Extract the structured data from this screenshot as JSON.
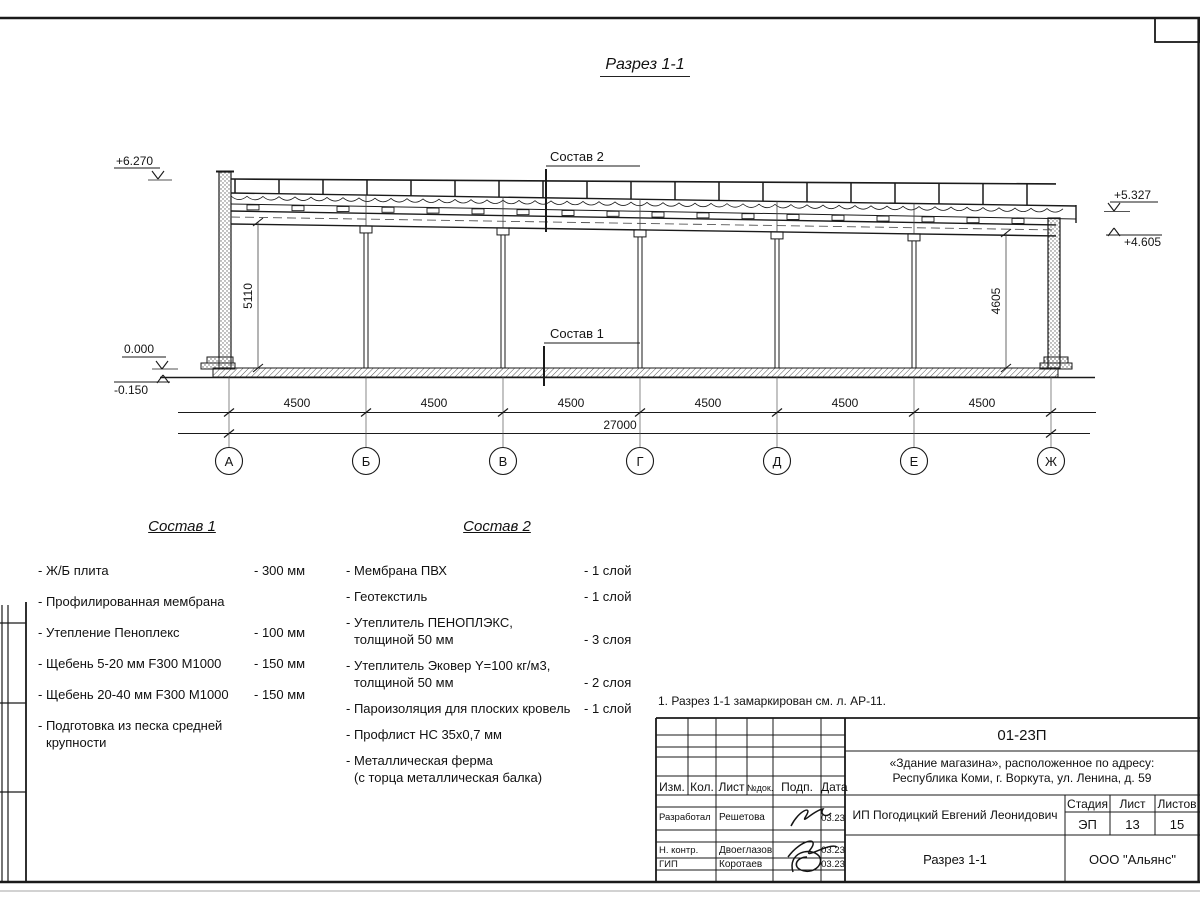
{
  "sheet": {
    "title": "Разрез 1-1",
    "note": "1. Разрез 1-1 замаркирован см. л. АР-11."
  },
  "drawing": {
    "elev_parapet": "+6.270",
    "elev_roof_high": "+5.327",
    "elev_roof_low": "+4.605",
    "elev_zero": "0.000",
    "elev_floor": "-0.150",
    "callout_roof": "Состав 2",
    "callout_floor": "Состав 1",
    "height_left": "5110",
    "height_right": "4605",
    "spans": [
      "4500",
      "4500",
      "4500",
      "4500",
      "4500",
      "4500"
    ],
    "total": "27000",
    "axes": [
      "А",
      "Б",
      "В",
      "Г",
      "Д",
      "Е",
      "Ж"
    ]
  },
  "sostav1": {
    "title": "Состав 1",
    "items": [
      {
        "name": "- Ж/Б плита",
        "name2": "",
        "value": "- 300 мм"
      },
      {
        "name": "- Профилированная мембрана",
        "name2": "",
        "value": ""
      },
      {
        "name": "- Утепление Пеноплекс",
        "name2": "",
        "value": "- 100 мм"
      },
      {
        "name": "-  Щебень 5-20 мм F300 М1000",
        "name2": "",
        "value": "- 150 мм"
      },
      {
        "name": "-  Щебень 20-40 мм F300 М1000",
        "name2": "",
        "value": "- 150 мм"
      },
      {
        "name": "- Подготовка из песка средней",
        "name2": "крупности",
        "value": ""
      }
    ]
  },
  "sostav2": {
    "title": "Состав 2",
    "items": [
      {
        "name": "- Мембрана ПВХ",
        "name2": "",
        "value": "- 1 слой"
      },
      {
        "name": "- Геотекстиль",
        "name2": "",
        "value": "- 1 слой"
      },
      {
        "name": "- Утеплитель ПЕНОПЛЭКС,",
        "name2": "толщиной 50 мм",
        "value": "- 3 слоя"
      },
      {
        "name": "- Утеплитель Эковер Y=100 кг/м3,",
        "name2": "толщиной 50 мм",
        "value": "- 2 слоя"
      },
      {
        "name": "- Пароизоляция для плоских кровель",
        "name2": "",
        "value": "- 1 слой"
      },
      {
        "name": "- Профлист НС 35х0,7 мм",
        "name2": "",
        "value": ""
      },
      {
        "name": "- Металлическая ферма",
        "name2": "(с торца металлическая балка)",
        "value": ""
      }
    ]
  },
  "titleblock": {
    "doc_number": "01-23П",
    "project_line1": "«Здание магазина», расположенное по адресу:",
    "project_line2": "Республика Коми, г. Воркута, ул. Ленина, д. 59",
    "client": "ИП Погодицкий Евгений Леонидович",
    "drawing_name": "Разрез 1-1",
    "company": "ООО \"Альянс\"",
    "stage_label": "Стадия",
    "sheet_label": "Лист",
    "sheets_label": "Листов",
    "stage": "ЭП",
    "sheet_no": "13",
    "sheets_total": "15",
    "header": [
      "Изм.",
      "Кол.",
      "Лист",
      "№док.",
      "Подп.",
      "Дата"
    ],
    "rows": [
      {
        "role": "Разработал",
        "name": "Решетова",
        "date": "03.23"
      },
      {
        "role": "Н. контр.",
        "name": "Двоеглазов",
        "date": "03.23"
      },
      {
        "role": "ГИП",
        "name": "Коротаев",
        "date": "03.23"
      }
    ]
  }
}
